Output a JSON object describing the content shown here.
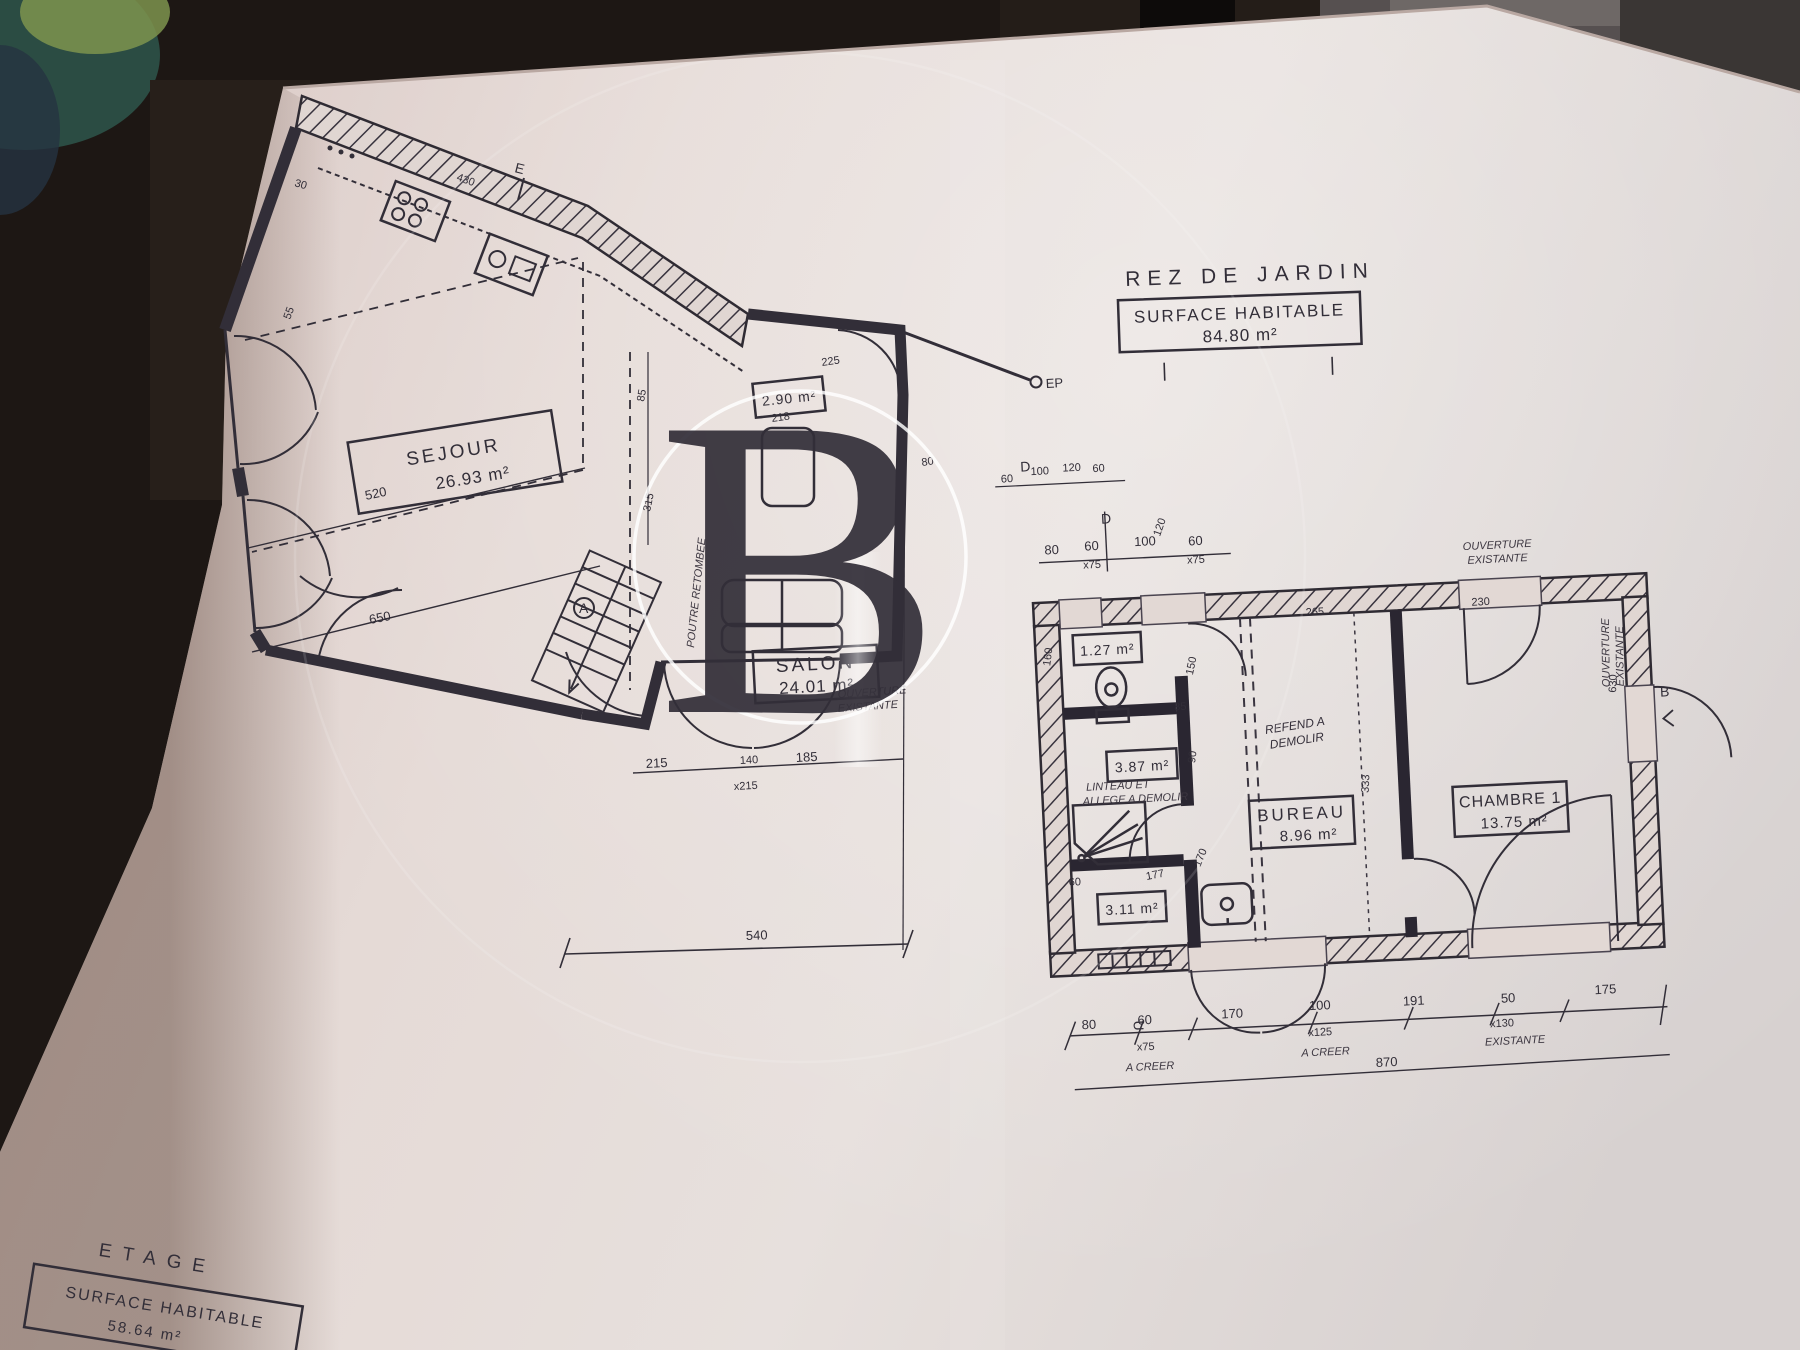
{
  "watermark": {
    "letter": "B"
  },
  "title_block": {
    "floor": "REZ DE JARDIN",
    "surface_label": "SURFACE HABITABLE",
    "surface_value": "84.80 m²"
  },
  "etage_block": {
    "floor": "ETAGE",
    "surface_label": "SURFACE HABITABLE",
    "surface_value": "58.64 m²"
  },
  "rooms": {
    "sejour": {
      "name": "SEJOUR",
      "area": "26.93 m²"
    },
    "salon": {
      "name": "SALON",
      "area": "24.01 m²"
    },
    "entry": {
      "area": "2.90 m²"
    },
    "wc": {
      "area": "1.27 m²"
    },
    "shower": {
      "area": "3.87 m²"
    },
    "cellier": {
      "area": "3.11 m²"
    },
    "bureau": {
      "name": "BUREAU",
      "area": "8.96 m²"
    },
    "chambre": {
      "name": "CHAMBRE 1",
      "area": "13.75 m²"
    }
  },
  "markers": {
    "a": "A",
    "b": "B",
    "d1": "D",
    "d2": "D",
    "e": "E",
    "ep": "EP",
    "u": "U"
  },
  "annotations": {
    "ouv_top1": "OUVERTURE",
    "ouv_top2": "EXISTANTE",
    "ouv_right1": "OUVERTURE",
    "ouv_right2": "EXISTANTE",
    "ouv_mid1": "OUVERTURE",
    "ouv_mid2": "EXISTANTE",
    "refend1": "REFEND A",
    "refend2": "DEMOLIR",
    "linteau1": "LINTEAU ET",
    "linteau2": "ALLEGE A DEMOLIR",
    "poutre": "POUTRE RETOMBEE",
    "creer1": "A CREER",
    "creer2": "A CREER",
    "exist": "EXISTANTE"
  },
  "dims": [
    "30",
    "430",
    "55",
    "520",
    "650",
    "215",
    "140",
    "185",
    "x215",
    "540",
    "85",
    "315",
    "225",
    "218",
    "80",
    "80",
    "60",
    "x75",
    "100",
    "120",
    "60",
    "x75",
    "60",
    "100",
    "120",
    "60",
    "160",
    "150",
    "85",
    "90",
    "265",
    "230",
    "630",
    "333",
    "177",
    "170",
    "60",
    "80",
    "60",
    "x75",
    "170",
    "100",
    "x125",
    "191",
    "50",
    "x130",
    "175",
    "870"
  ]
}
